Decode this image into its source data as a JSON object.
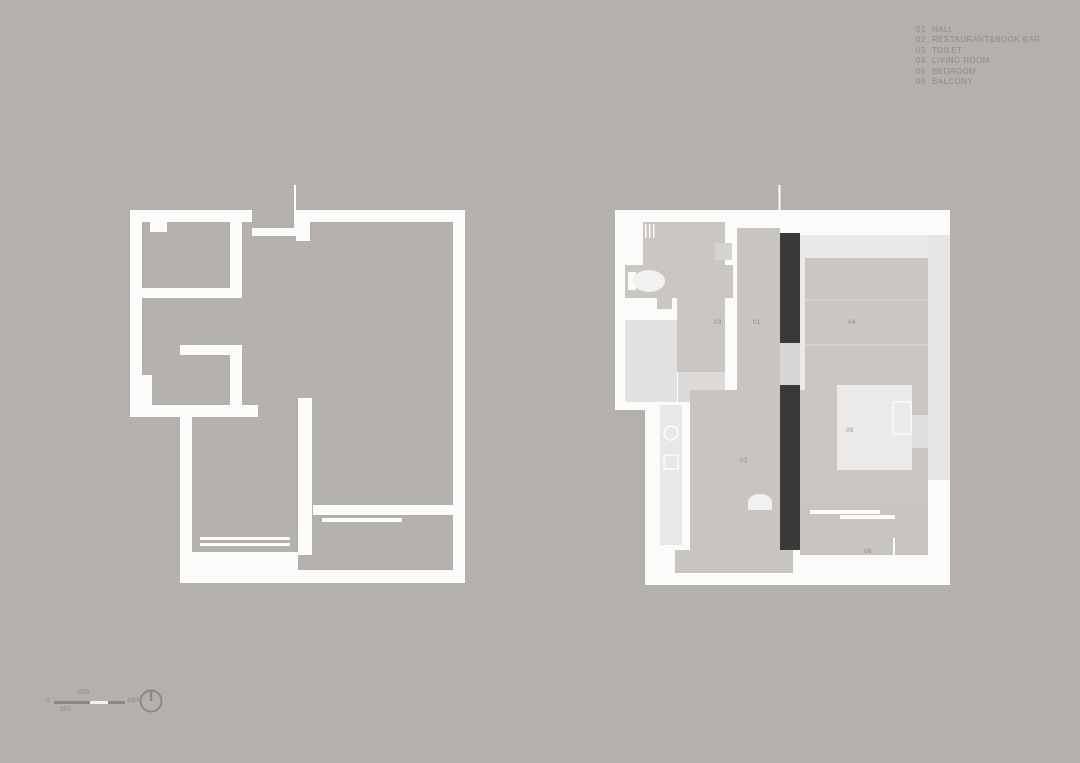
{
  "legend": {
    "items": [
      {
        "num": "01",
        "label": "HALL"
      },
      {
        "num": "02",
        "label": "RESTAURANT&BOOK BAR"
      },
      {
        "num": "03",
        "label": "TOILET"
      },
      {
        "num": "04",
        "label": "LIVING ROOM"
      },
      {
        "num": "05",
        "label": "BEDROOM"
      },
      {
        "num": "06",
        "label": "BALCONY"
      }
    ]
  },
  "room_numbers": {
    "hall": "01",
    "restaurant": "02",
    "toilet": "03",
    "living": "04",
    "bedroom": "05",
    "balcony": "06"
  },
  "scale_bar": {
    "zero": "0",
    "quarter": "250",
    "half": "500",
    "full": "1000"
  },
  "colors": {
    "background": "#b4b0ad",
    "wall_white": "#fcfcfb",
    "floor_light": "#eae9e7",
    "rug_gray": "#c9c6c3",
    "dark_cabinet": "#3a3938",
    "label_gray": "#8d8883"
  }
}
